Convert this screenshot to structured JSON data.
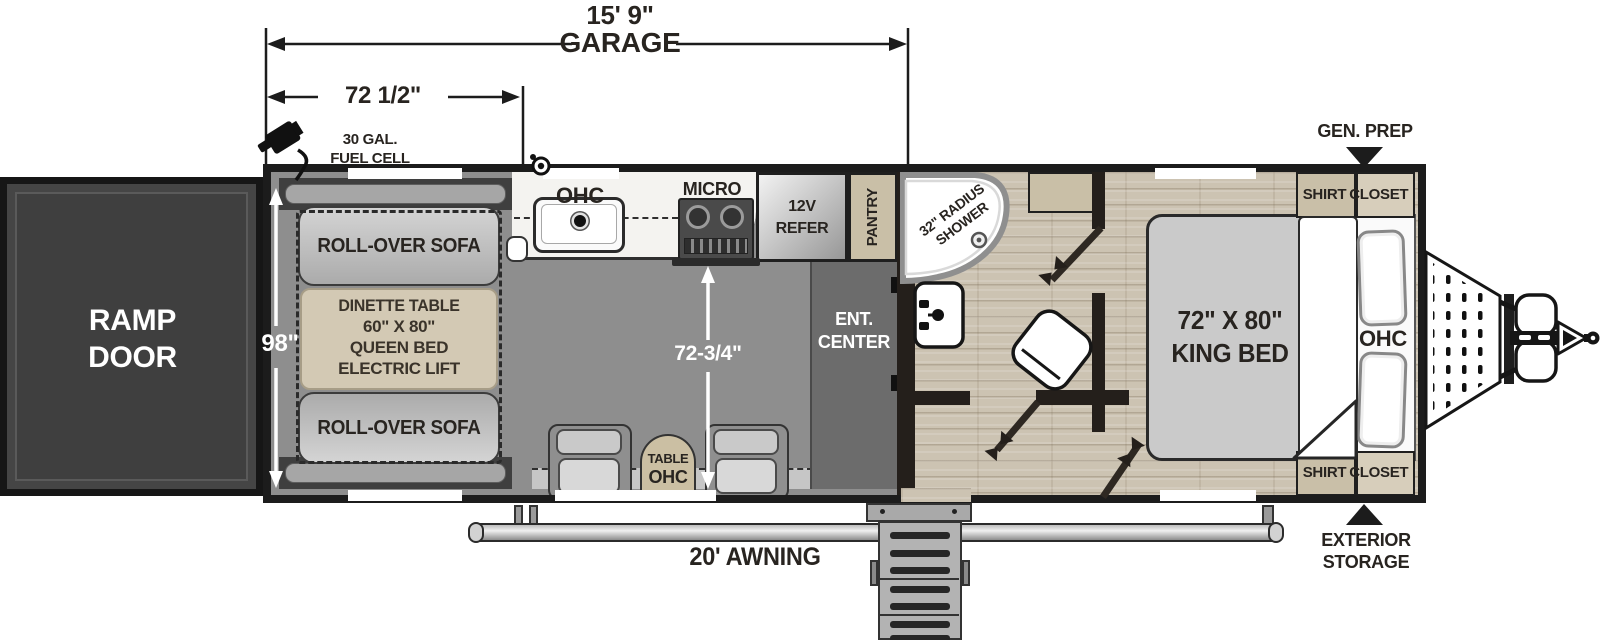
{
  "dims": {
    "garage_length": "15' 9\"",
    "garage_word": "GARAGE",
    "front_width": "72 1/2\"",
    "body_width": "98\"",
    "kitchen_aisle": "72-3/4\""
  },
  "exterior": {
    "fuel_line1": "30 GAL.",
    "fuel_line2": "FUEL CELL",
    "gen_prep": "GEN. PREP",
    "ext_storage_line1": "EXTERIOR",
    "ext_storage_line2": "STORAGE",
    "awning": "20' AWNING",
    "ramp_line1": "RAMP",
    "ramp_line2": "DOOR"
  },
  "garage": {
    "sofa_top": "ROLL-OVER SOFA",
    "sofa_bottom": "ROLL-OVER SOFA",
    "dinette_line1": "DINETTE TABLE",
    "dinette_line2": "60\" X 80\"",
    "dinette_line3": "QUEEN BED",
    "dinette_line4": "ELECTRIC LIFT",
    "ent_line1": "ENT.",
    "ent_line2": "CENTER",
    "table": "TABLE",
    "table_ohc": "OHC"
  },
  "kitchen": {
    "ohc": "OHC",
    "micro": "MICRO",
    "refer_line1": "12V",
    "refer_line2": "REFER",
    "pantry": "PANTRY"
  },
  "bath": {
    "shower_line1": "32\" RADIUS",
    "shower_line2": "SHOWER"
  },
  "bedroom": {
    "bed_line1": "72\" X 80\"",
    "bed_line2": "KING BED",
    "ohc": "OHC",
    "closet_top_left": "SHIRT",
    "closet_top_right": "CLOSET",
    "closet_bottom_left": "SHIRT",
    "closet_bottom_right": "CLOSET"
  },
  "colors": {
    "wall": "#241f1b",
    "garage_floor": "#8d8d8d",
    "wood_floor": "#ccc3b2",
    "tan": "#d3c9b4",
    "dark_cabinet": "#6c6c6c",
    "ramp": "#454545"
  }
}
